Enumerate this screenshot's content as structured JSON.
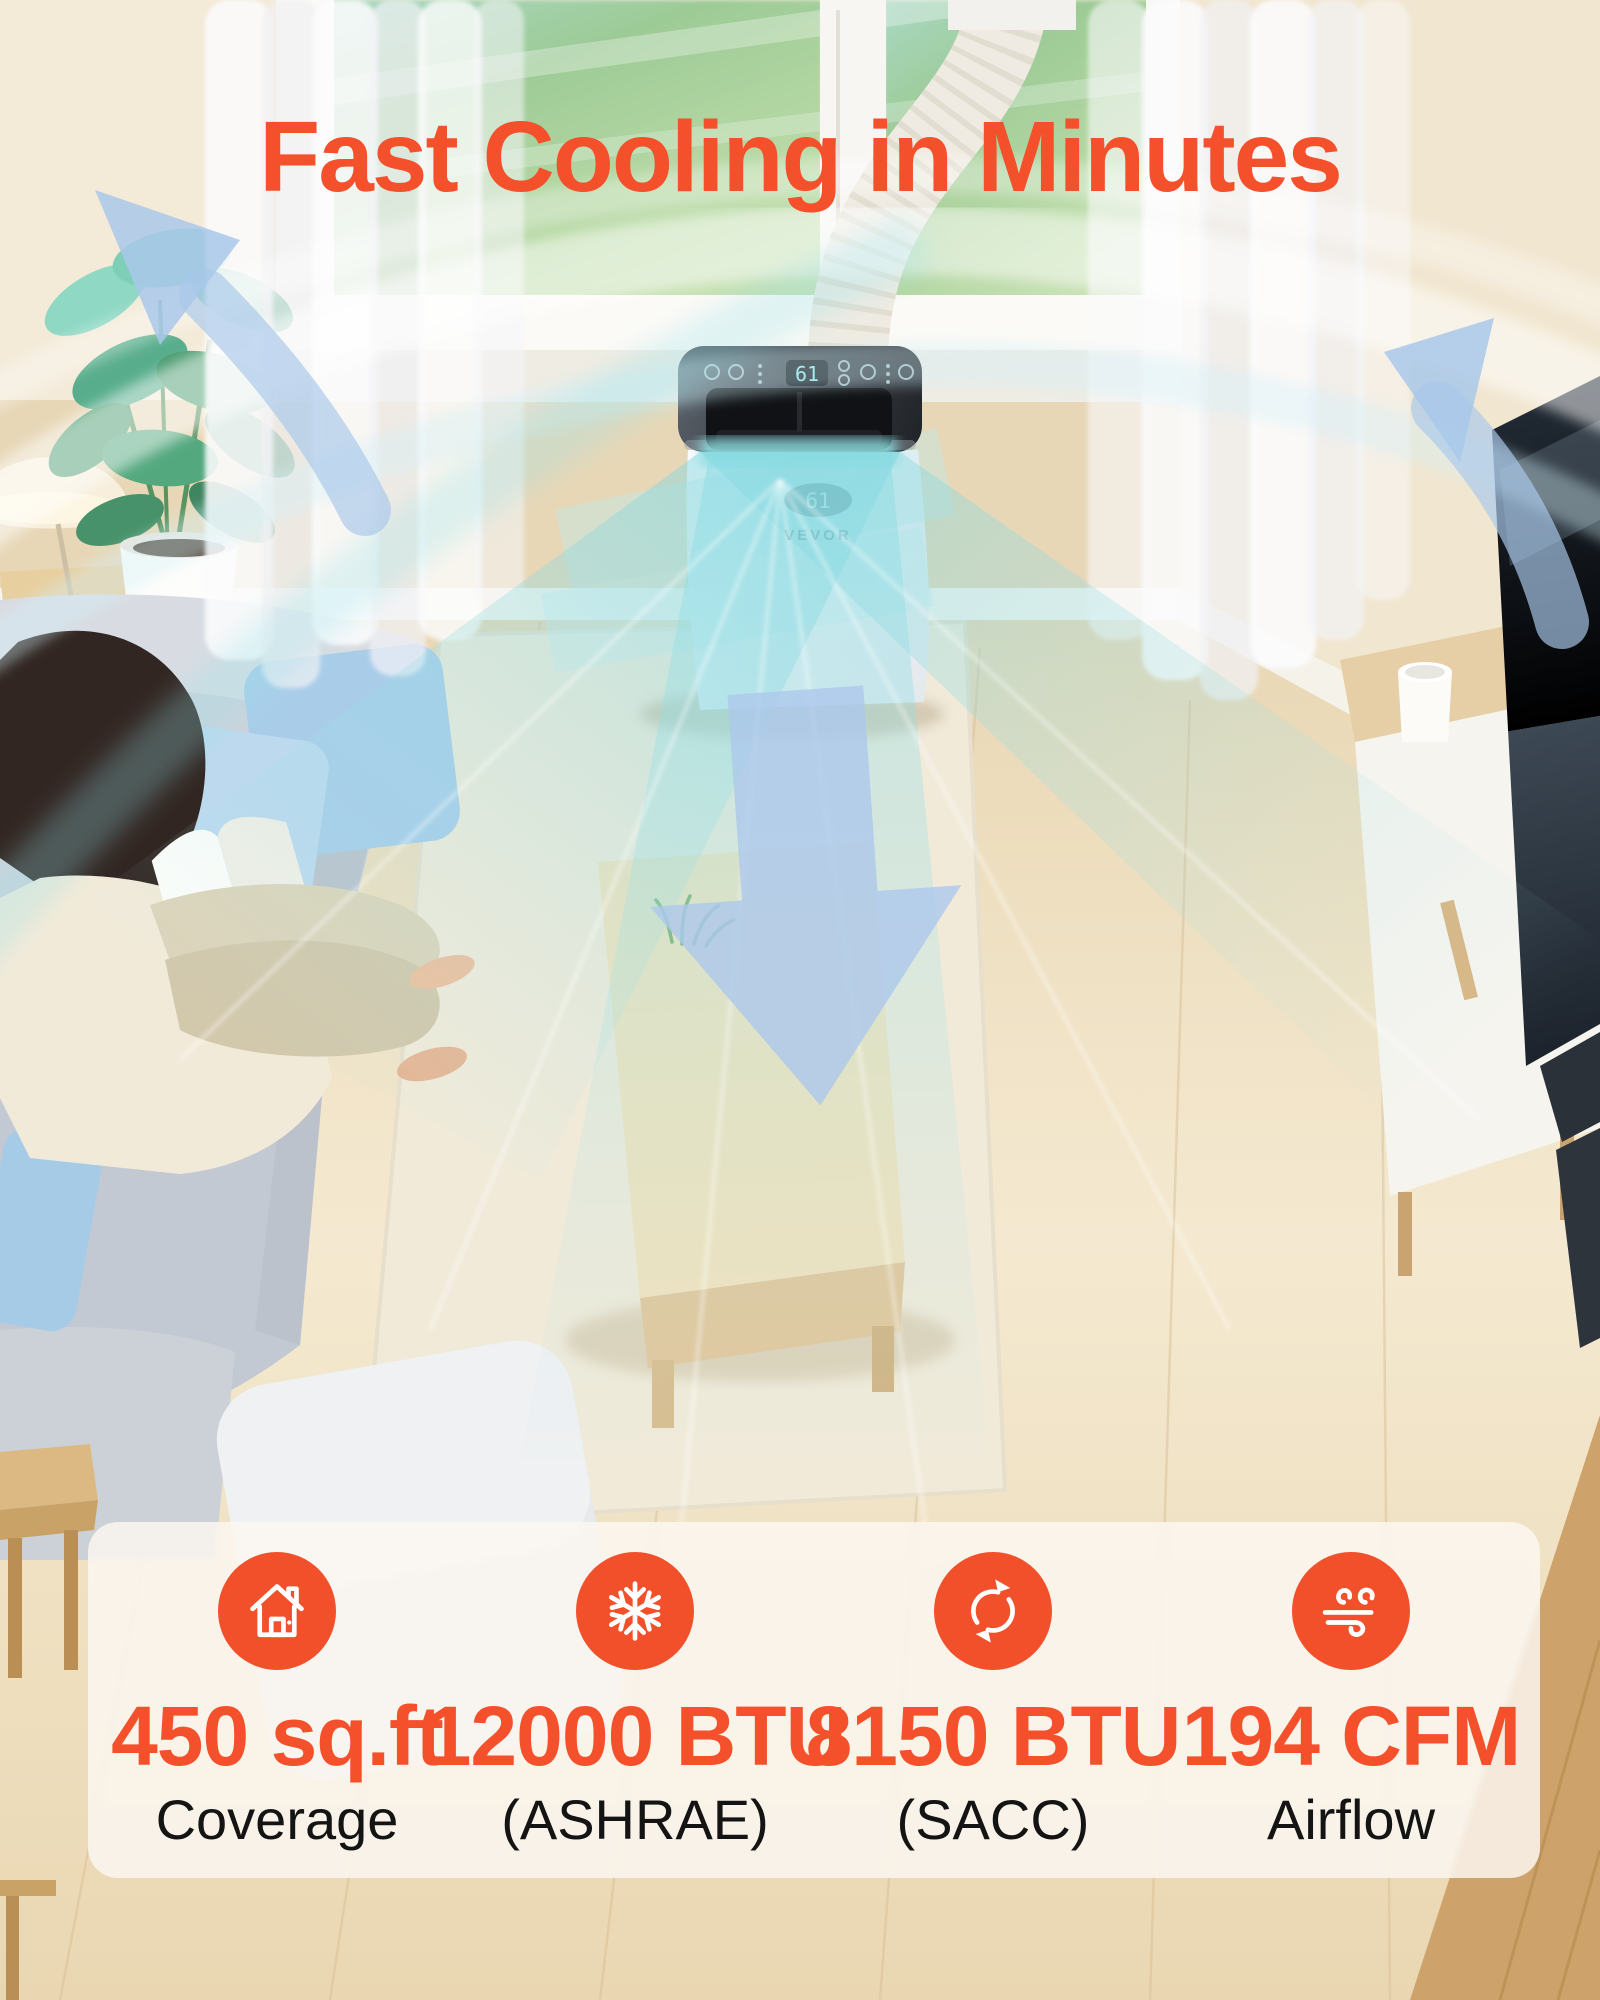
{
  "title": {
    "text": "Fast Cooling in Minutes"
  },
  "product": {
    "brand": "VEVOR",
    "panel_display": "61",
    "front_display": "61"
  },
  "stats": [
    {
      "icon": "house-icon",
      "value": "450 sq.ft",
      "label": "Coverage"
    },
    {
      "icon": "snowflake-icon",
      "value": "12000 BTU",
      "label": "(ASHRAE)"
    },
    {
      "icon": "sync-icon",
      "value": "8150 BTU",
      "label": "(SACC)"
    },
    {
      "icon": "wind-icon",
      "value": "194 CFM",
      "label": "Airflow"
    }
  ],
  "colors": {
    "accent_orange": "#F4502B",
    "icon_circle_orange": "#F2502A",
    "arrow_blue": "#A9C8EA",
    "airflow_teal": "#7FD8DE",
    "card_background": "rgba(251,247,241,0.84)",
    "label_text": "#141414"
  }
}
